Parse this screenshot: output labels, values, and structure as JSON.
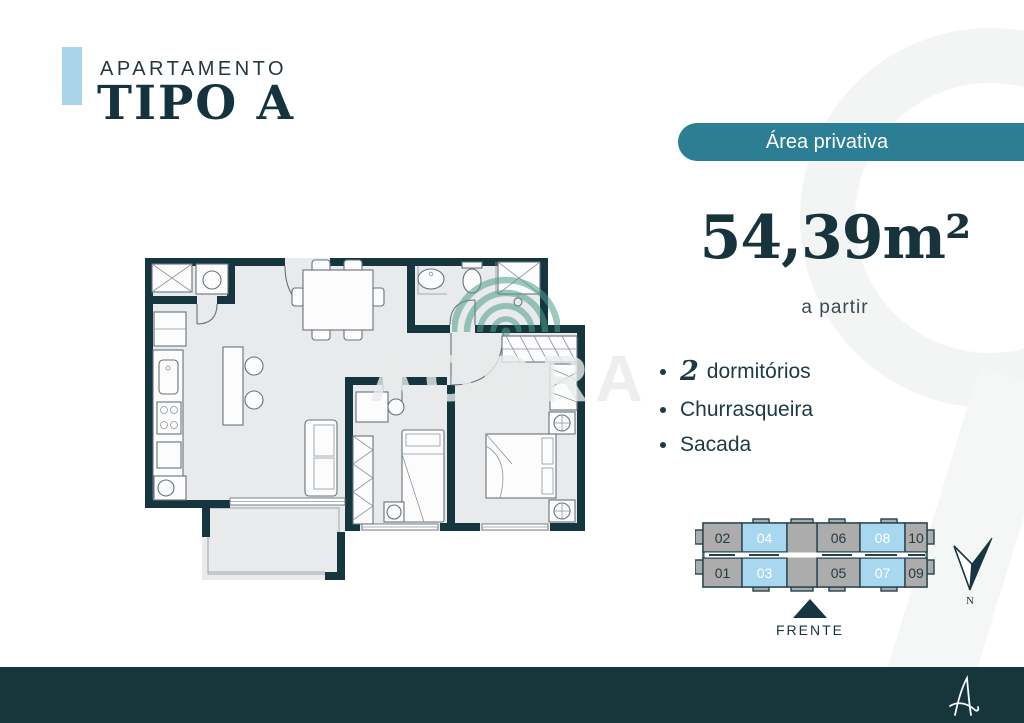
{
  "colors": {
    "accent_blue": "#A9D4EA",
    "badge_teal": "#2B7E93",
    "dark_teal": "#17363C",
    "unit_gray": "#ACACAC",
    "unit_highlight_blue": "#A7D8EF",
    "watermark_green": "#4E9D8B"
  },
  "header": {
    "kicker": "APARTAMENTO",
    "title": "TIPO A"
  },
  "badge": {
    "label": "Área privativa"
  },
  "area": {
    "value": "54,39m²",
    "note": "a partir"
  },
  "features": [
    {
      "value": "2",
      "label": "dormitórios"
    },
    {
      "value": "",
      "label": "Churrasqueira"
    },
    {
      "value": "",
      "label": "Sacada"
    }
  ],
  "watermark": {
    "brand": "AGORA"
  },
  "units": {
    "highlighted": [
      "03",
      "04",
      "07",
      "08"
    ],
    "top": [
      {
        "label": "02",
        "fill": "#ACACAC",
        "text_color": "#253B44"
      },
      {
        "label": "04",
        "fill": "#A7D8EF",
        "text_color": "#FFFFFF"
      },
      {
        "label": "06",
        "fill": "#ACACAC",
        "text_color": "#253B44"
      },
      {
        "label": "08",
        "fill": "#A7D8EF",
        "text_color": "#FFFFFF"
      },
      {
        "label": "10",
        "fill": "#ACACAC",
        "text_color": "#253B44"
      }
    ],
    "bottom": [
      {
        "label": "01",
        "fill": "#ACACAC",
        "text_color": "#253B44"
      },
      {
        "label": "03",
        "fill": "#A7D8EF",
        "text_color": "#FFFFFF"
      },
      {
        "label": "05",
        "fill": "#ACACAC",
        "text_color": "#253B44"
      },
      {
        "label": "07",
        "fill": "#A7D8EF",
        "text_color": "#FFFFFF"
      },
      {
        "label": "09",
        "fill": "#ACACAC",
        "text_color": "#253B44"
      }
    ]
  },
  "diagram": {
    "front_label": "FRENTE",
    "compass_label": "N"
  }
}
